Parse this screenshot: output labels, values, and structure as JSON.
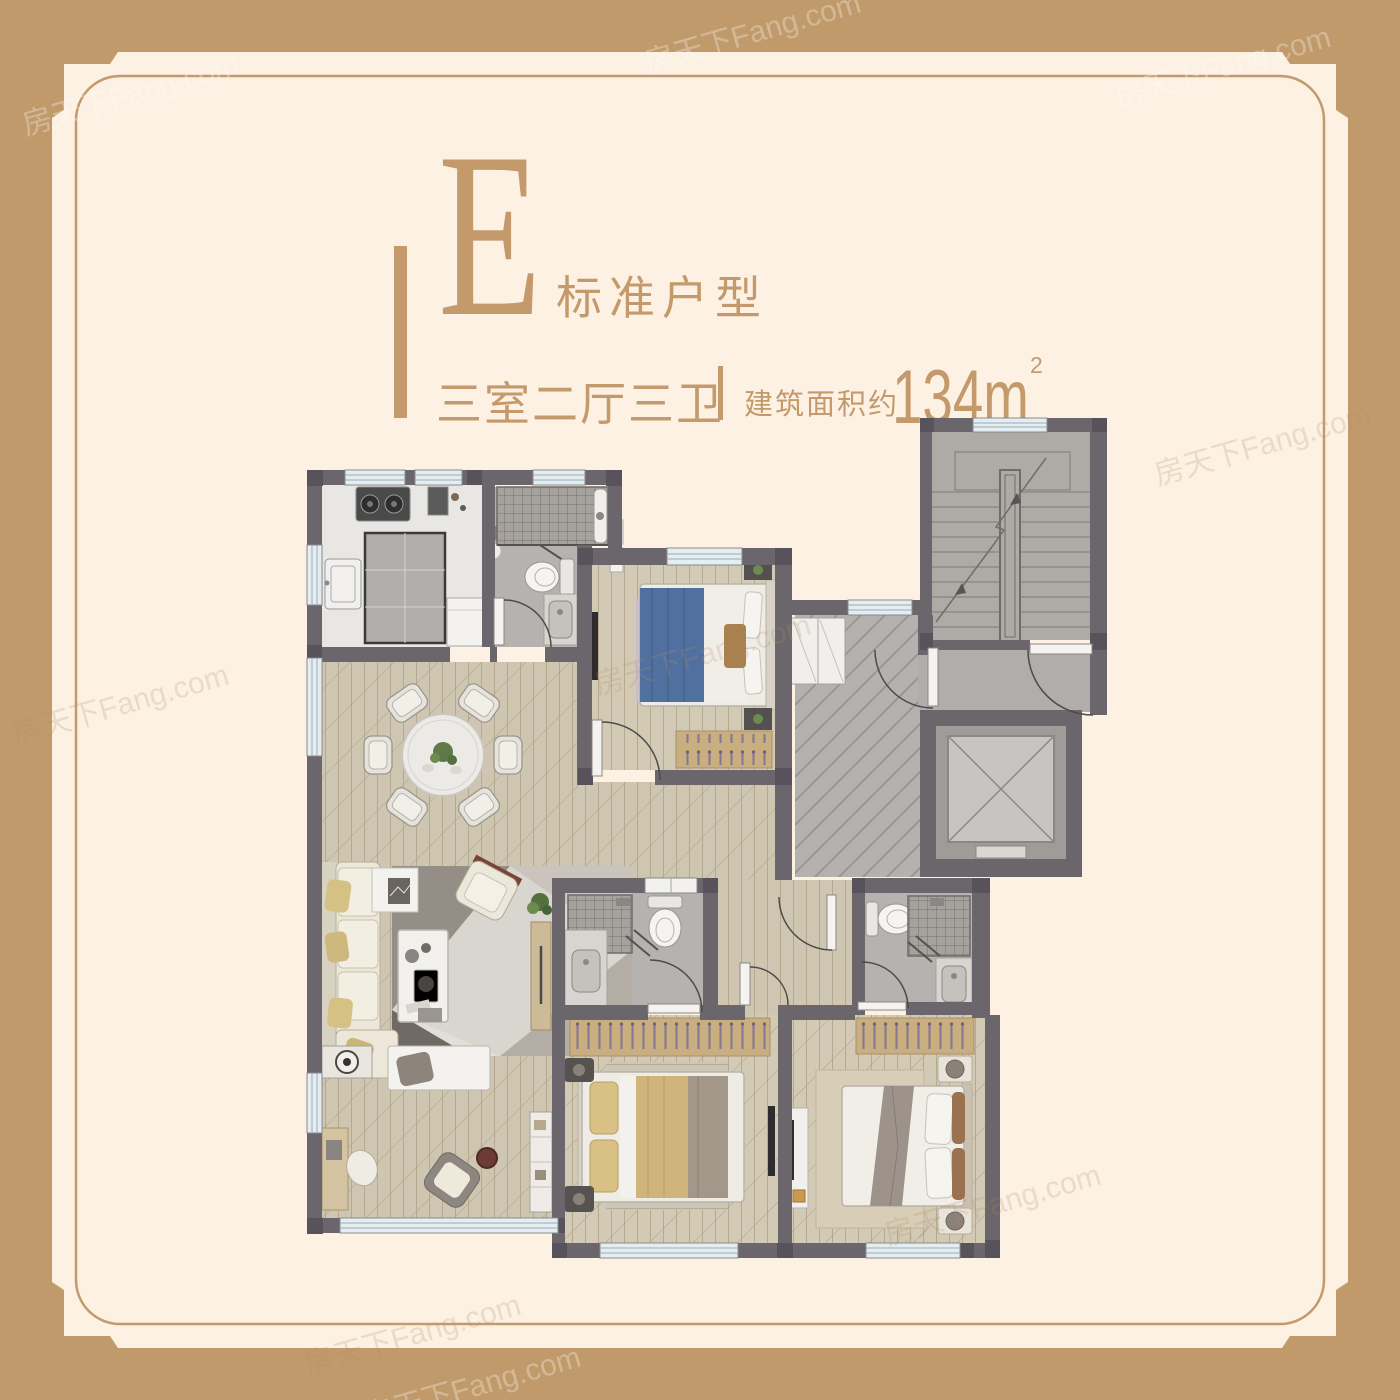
{
  "poster": {
    "header": {
      "block_letter": "E",
      "block_label": "标准户型",
      "layout_text": "三室二厅三卫",
      "area_label": "建筑面积约",
      "area_value": "134m",
      "area_superscript": "2"
    },
    "watermark_text": "房天下Fang.com",
    "colors": {
      "page_background": "#c09a6a",
      "panel_background": "#fcf1e2",
      "accent_gold": "#c49a6c",
      "wall": "#6b666b",
      "column": "#57525b",
      "wood_floor": "#cfc6b1",
      "bedroom_floor": "#d3cab6",
      "tile_floor": "#b5b2af",
      "herringbone_floor": "#b4b1ae",
      "stair_floor": "#aeaba7",
      "window_glass": "#e4edf2",
      "shower_tile": "#a5a29e",
      "bed_blue": "#50709f",
      "bed_yellow": "#cfb47c",
      "bed_taupe": "#9d938b",
      "sofa_cream": "#ece7d9",
      "wardrobe_wood": "#c9ae7f",
      "rug_lilac": "#c9bfc8",
      "rug_beige": "#d8cdb6"
    }
  }
}
